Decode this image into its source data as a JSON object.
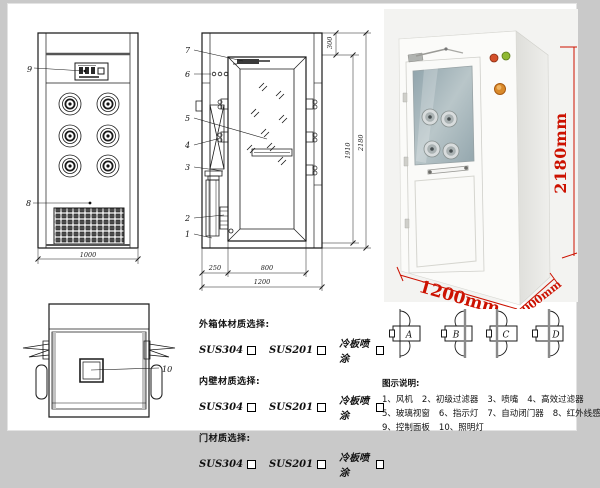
{
  "page": {
    "background": "#c9c9c9",
    "paper": "#ffffff"
  },
  "front_view": {
    "panel_label": "9",
    "grille_label": "8",
    "width_dim": "1000"
  },
  "side_view": {
    "labels": [
      "7",
      "6",
      "5",
      "4",
      "3",
      "2",
      "1"
    ],
    "dim_top": "300",
    "dim_door": "1910",
    "dim_height": "2180",
    "dim_left": "250",
    "dim_door_w": "800",
    "dim_width": "1200"
  },
  "top_view": {
    "light_label": "10"
  },
  "photo": {
    "dim_height": "2180mm",
    "dim_width": "1200mm",
    "dim_depth": "1000mm",
    "accent_red": "#cc1100",
    "indicator_red": "#d4502a",
    "indicator_green": "#8fb832",
    "button_amber": "#d98a2b"
  },
  "door_options": {
    "labels": [
      "A",
      "B",
      "C",
      "D"
    ]
  },
  "materials": {
    "sections": [
      {
        "title": "外箱体材质选择:",
        "options": [
          "SUS304",
          "SUS201",
          "冷板喷涂"
        ]
      },
      {
        "title": "内壁材质选择:",
        "options": [
          "SUS304",
          "SUS201",
          "冷板喷涂"
        ]
      },
      {
        "title": "门材质选择:",
        "options": [
          "SUS304",
          "SUS201",
          "冷板喷涂"
        ]
      }
    ]
  },
  "legend": {
    "title": "图示说明:",
    "rows": [
      [
        "1、风机",
        "2、初级过滤器",
        "3、喷嘴",
        "4、高效过滤器"
      ],
      [
        "5、玻璃视窗",
        "6、指示灯",
        "7、自动闭门器",
        "8、红外线感应器"
      ],
      [
        "9、控制面板",
        "10、照明灯"
      ]
    ]
  }
}
